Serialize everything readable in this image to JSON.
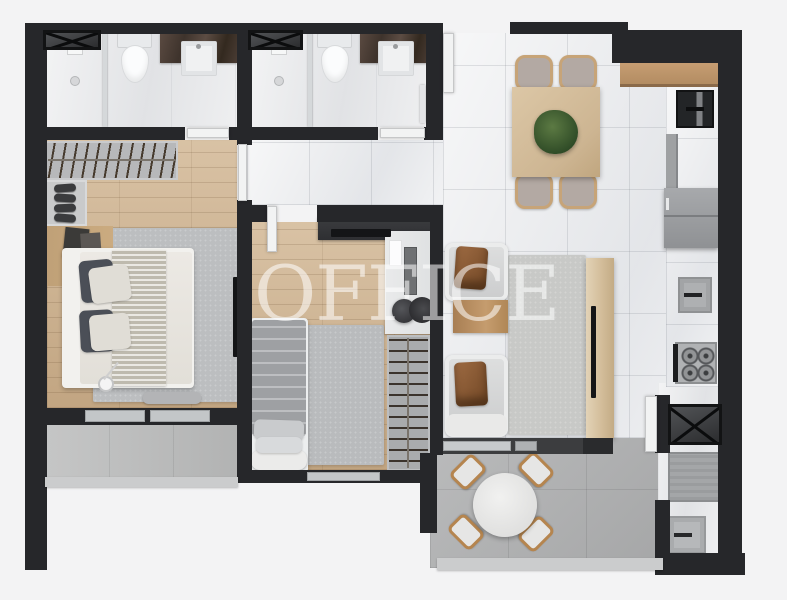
{
  "watermark": {
    "text": "OFFICE"
  },
  "colors": {
    "background": "#f3f3f4",
    "wall": "#26272a",
    "marble_floor": "#edeef0",
    "bath_floor": "#e7e8ea",
    "wood_floor": "#ccb08d",
    "concrete": "#b2b3b4",
    "concrete_light": "#bdbebe",
    "rug": "#bcbec0",
    "counter_wood": "#b9926a",
    "dark_marble": "#4e4037",
    "appliance_gray": "#9b9da0",
    "glass": "#c3c6c8",
    "door_white": "#f2f3f3",
    "leather": "#8a5a36",
    "plant_green": "#44603a",
    "sofa_gray": "#d8d8d9",
    "watermark_color": "rgba(255,255,255,0.55)"
  },
  "rooms": {
    "bathroom_1": [
      "shaft-box",
      "shower",
      "glass-partition",
      "toilet",
      "stone-vanity",
      "sink"
    ],
    "bathroom_2": [
      "shaft-box",
      "shower",
      "glass-partition",
      "toilet",
      "stone-vanity",
      "sink",
      "towel-rail"
    ],
    "master_bedroom": [
      "open-wardrobe-rack",
      "shoe-shelf",
      "console-with-frames",
      "plant",
      "double-bed",
      "area-rug",
      "floor-lamp",
      "wall-tv",
      "foot-bench"
    ],
    "bedroom_2": [
      "tv-dresser",
      "tv",
      "desk",
      "monitor",
      "desk-chair",
      "single-bed",
      "area-rug",
      "hanger-closet"
    ],
    "living_dining": [
      "dining-table",
      "dining-chairs",
      "centerpiece-plant",
      "armchair",
      "leather-cushion",
      "side-table",
      "area-rug",
      "tv-panel",
      "tv",
      "sliding-door"
    ],
    "kitchen": [
      "wood-counter",
      "black-sink-unit",
      "tall-cabinet",
      "refrigerator",
      "prep-sink",
      "cooktop-4-burners"
    ],
    "service_area": [
      "shaft-box",
      "vent-grill",
      "laundry-sink",
      "service-door"
    ],
    "balcony": [
      "round-table",
      "wood-chairs",
      "glass-railing"
    ],
    "master_balcony": [
      "railing"
    ]
  }
}
